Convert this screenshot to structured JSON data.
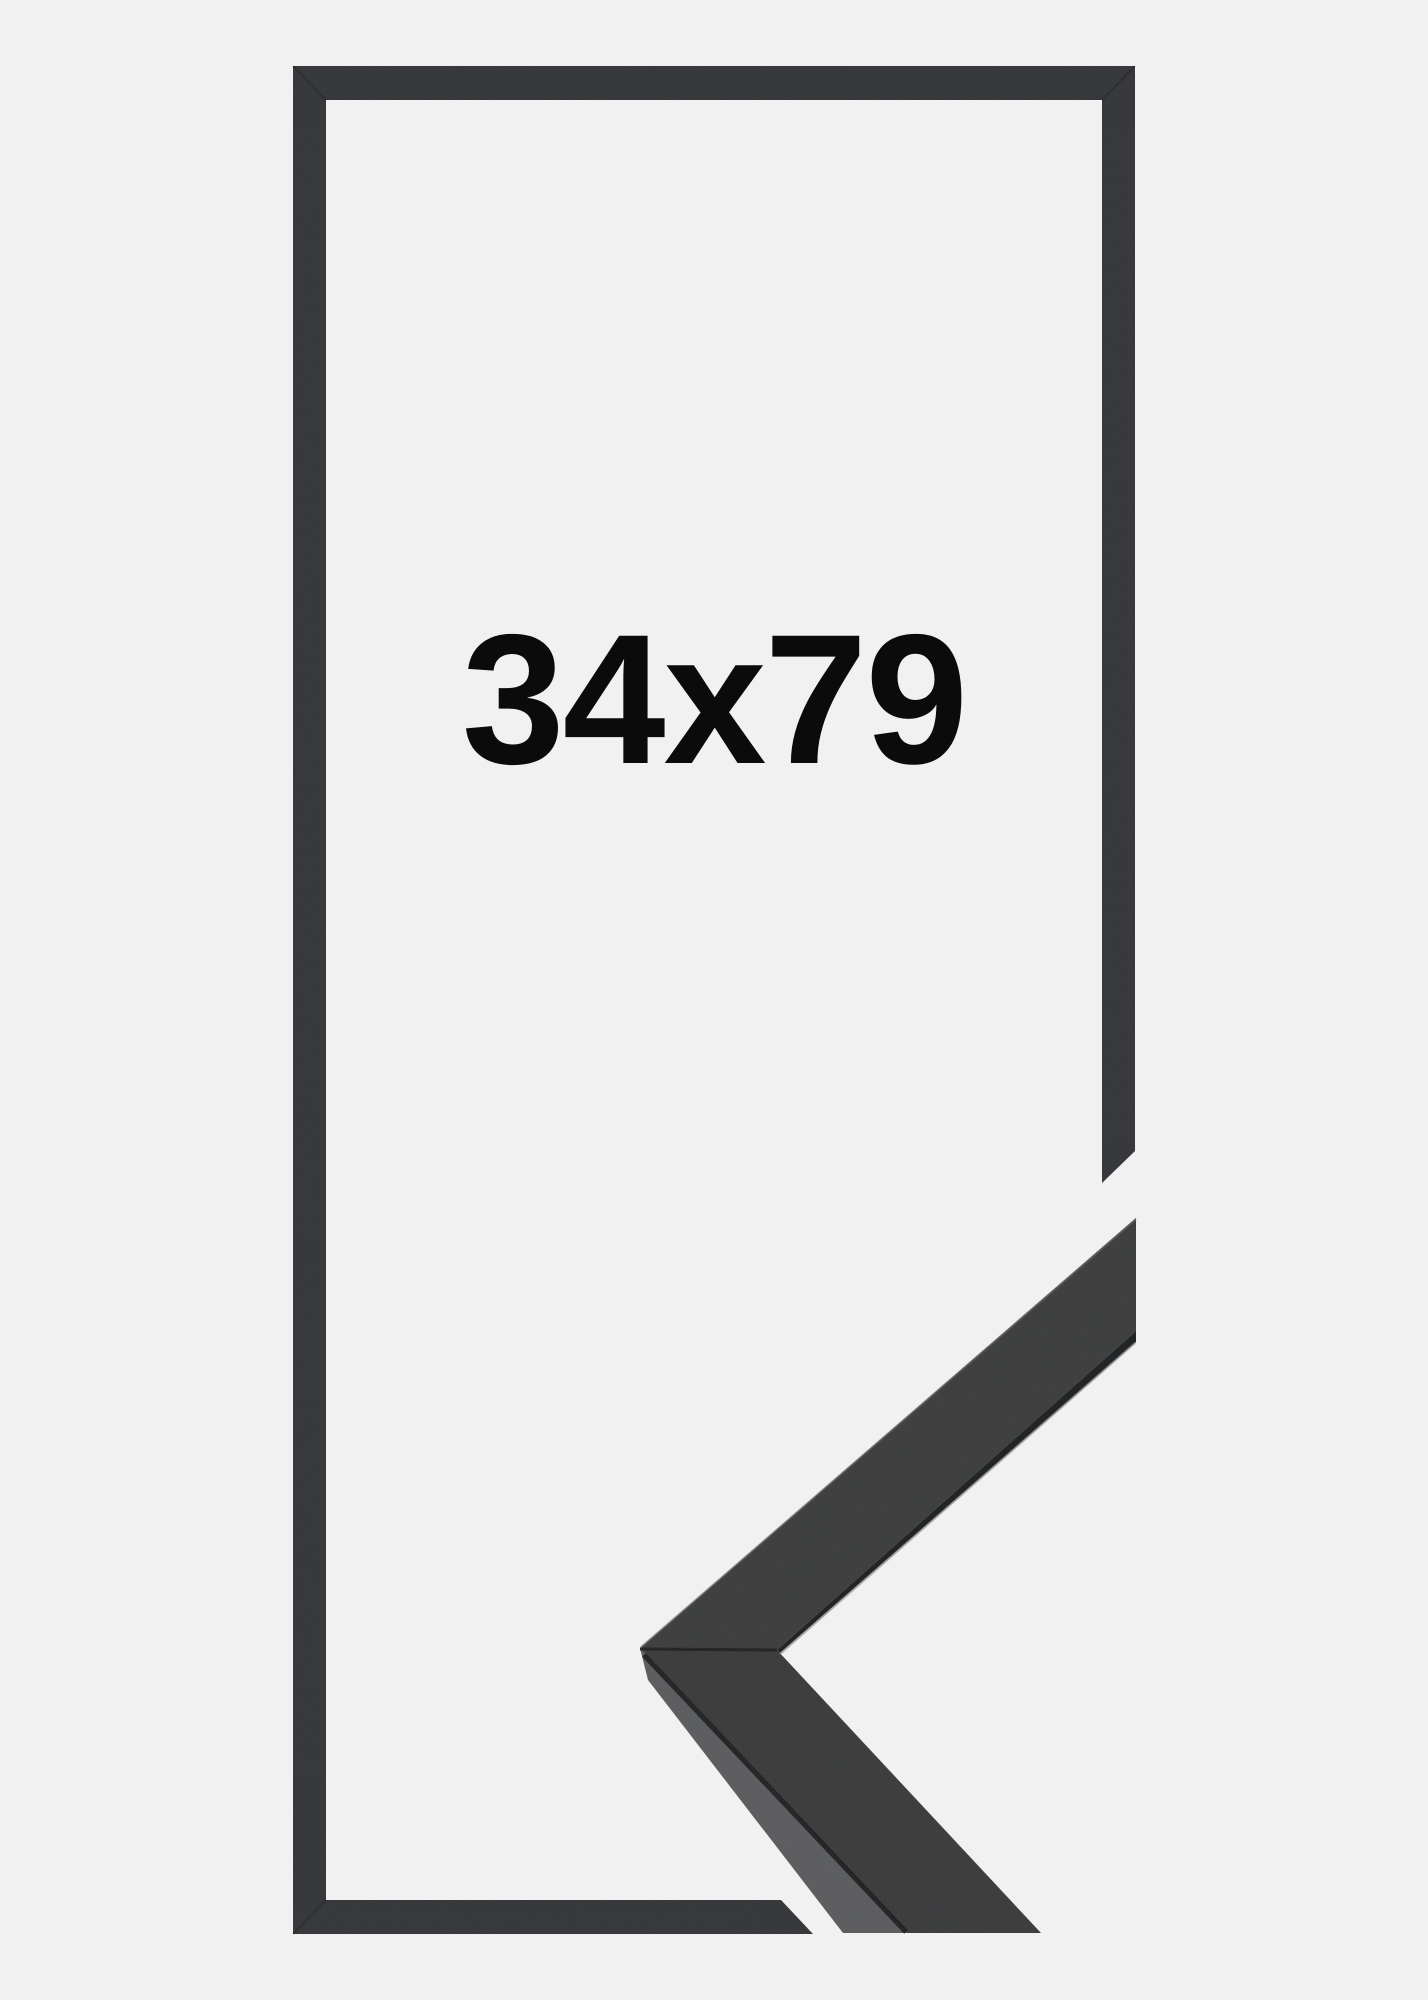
{
  "product_image": {
    "size_label": "34x79",
    "text_color": "#0b0b0c",
    "background_color": "#f1f1f2",
    "frame_color": "#343639",
    "moulding": {
      "face_color": "#3a3b3c",
      "lower_face_color": "#38393a",
      "side_color": "#595a5c",
      "crease_color": "#1a1b1c",
      "dark_edge_color": "#232425",
      "highlight_color": "#8a8b8d",
      "top_rim_color": "#6f7072"
    }
  }
}
